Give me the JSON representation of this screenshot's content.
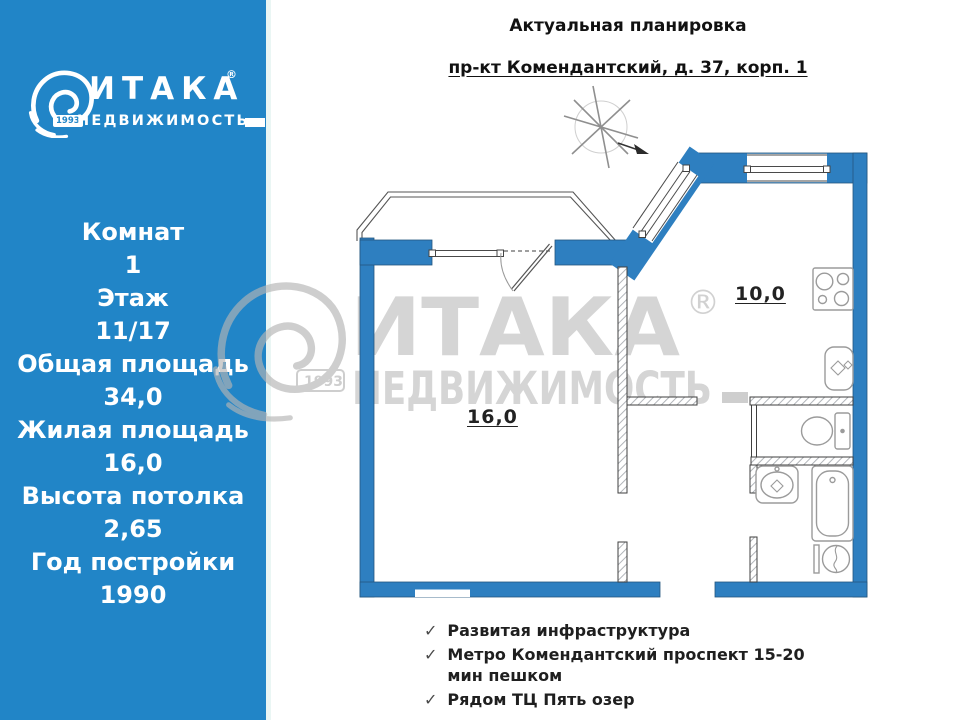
{
  "brand": {
    "name": "ИТАКА",
    "registered": "®",
    "subtitle": "НЕДВИЖИМОСТЬ",
    "year": "1993"
  },
  "header": {
    "title": "Актуальная планировка",
    "address": "пр-кт Комендантский, д. 37, корп. 1"
  },
  "sidebar": {
    "stats": [
      {
        "label": "Комнат",
        "value": "1"
      },
      {
        "label": "Этаж",
        "value": "11/17"
      },
      {
        "label": "Общая площадь",
        "value": "34,0"
      },
      {
        "label": "Жилая площадь",
        "value": "16,0"
      },
      {
        "label": "Высота потолка",
        "value": "2,65"
      },
      {
        "label": "Год постройки",
        "value": "1990"
      }
    ]
  },
  "floor_plan": {
    "rooms": [
      {
        "name": "living-room",
        "area_label": "16,0"
      },
      {
        "name": "kitchen",
        "area_label": "10,0"
      }
    ],
    "fixtures": [
      "stove",
      "kitchen-sink",
      "toilet",
      "bathroom-sink",
      "bathtub",
      "washing-machine"
    ],
    "compass": "north-compass-arrow"
  },
  "features": {
    "check_glyph": "✓",
    "items": [
      "Развитая инфраструктура",
      "Метро Комендантский проспект 15-20 мин пешком",
      "Рядом ТЦ Пять озер"
    ]
  },
  "colors": {
    "sidebar_blue": "#2185C7",
    "wall_blue": "#2E7FC0",
    "watermark_gray": "#C9C9C9",
    "text_dark": "#1A1A1A"
  }
}
